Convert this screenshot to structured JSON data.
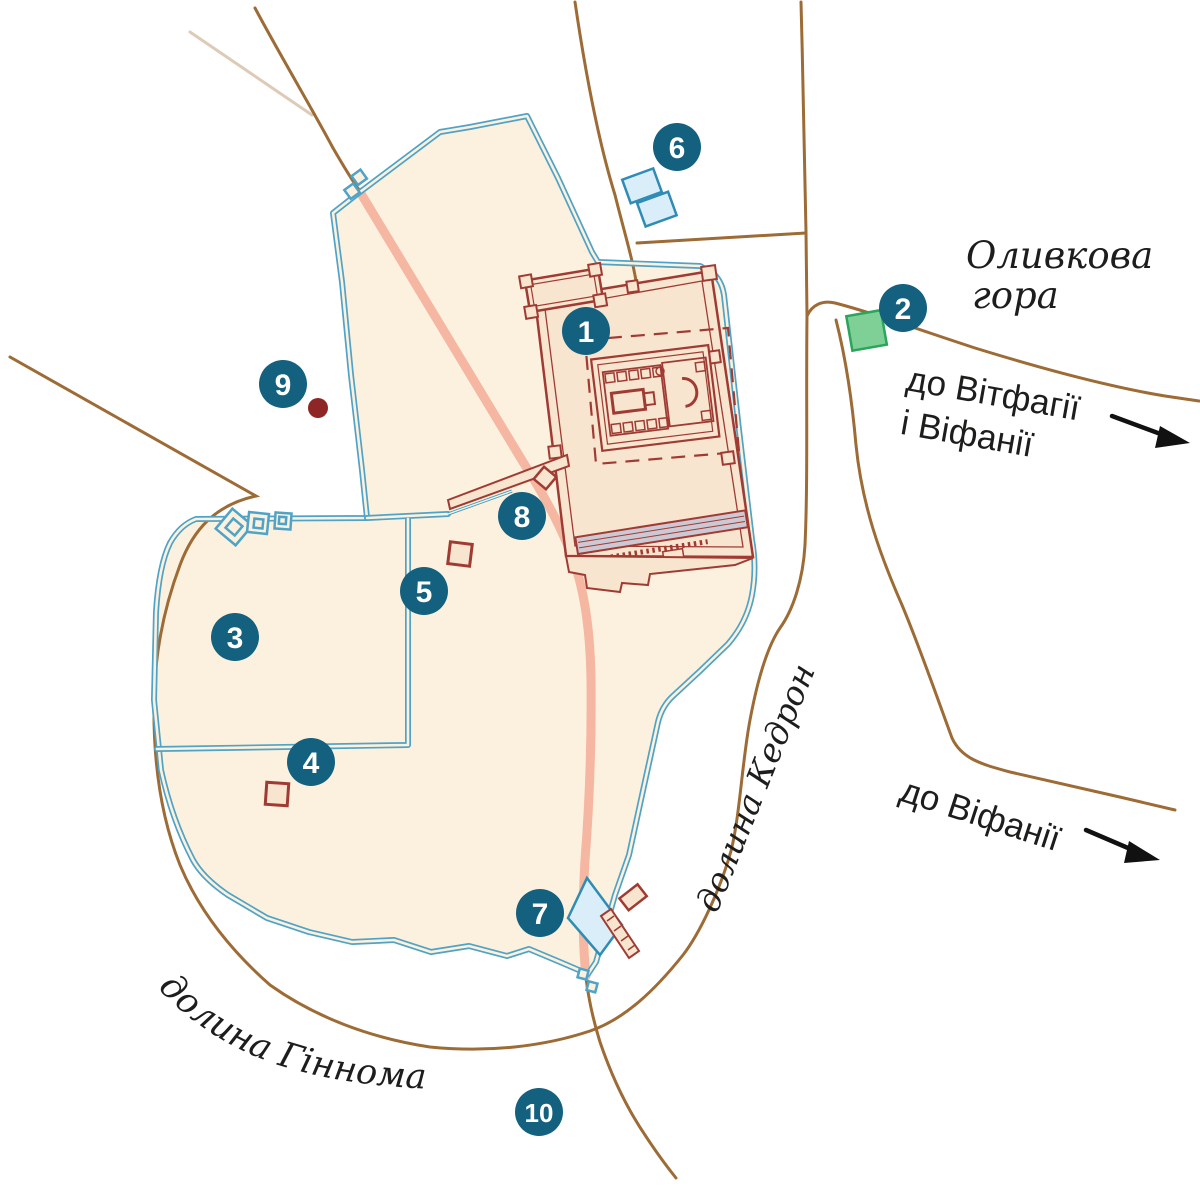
{
  "map": {
    "markers": [
      {
        "number": "1"
      },
      {
        "number": "2"
      },
      {
        "number": "3"
      },
      {
        "number": "4"
      },
      {
        "number": "5"
      },
      {
        "number": "6"
      },
      {
        "number": "7"
      },
      {
        "number": "8"
      },
      {
        "number": "9"
      },
      {
        "number": "10"
      }
    ],
    "labels": {
      "olive_mount_line1": "Оливкова",
      "olive_mount_line2": "гора",
      "to_bethphage_line1": "до Вітфагії",
      "to_bethphage_line2": "і Віфанії",
      "to_bethany": "до Віфанії",
      "kidron_valley": "долина Кедрон",
      "hinnom_valley": "долина Гіннома"
    },
    "colors": {
      "marker": "#14607f",
      "city_fill": "#fcf1de",
      "temple_fill": "#f8e5cf",
      "wall_blue": "#4fa3c6",
      "temple_red": "#a03b33",
      "stoa_fill": "#cdc9d4",
      "road_brown": "#9d6b35",
      "road_pink": "#f5b6a2",
      "pool_fill": "#d9eef9",
      "pool_stroke": "#2f8cb5",
      "green_fill": "#7ed096",
      "green_stroke": "#2ba45c",
      "dot_red": "#8e2626",
      "text": "#1d1d1b",
      "arrow": "#111111"
    }
  }
}
